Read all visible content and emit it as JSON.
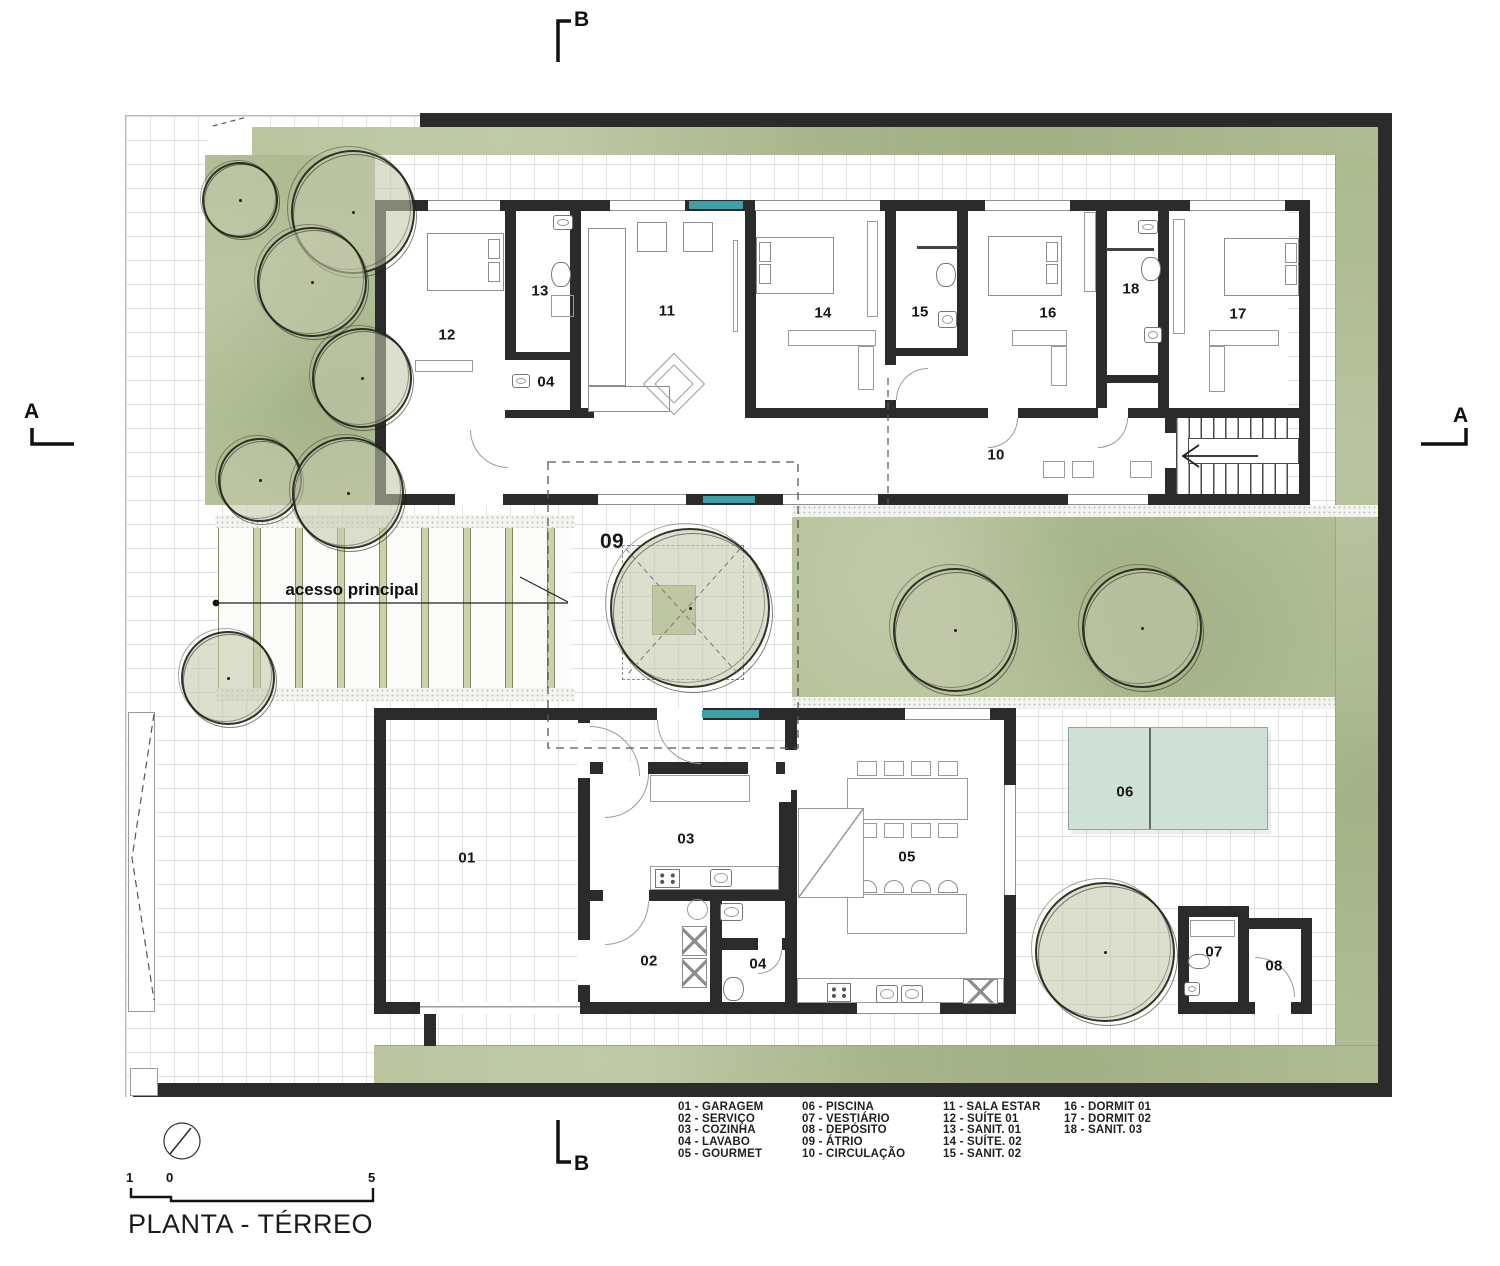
{
  "title": "PLANTA - TÉRREO",
  "annotations": {
    "access_label": "acesso principal",
    "section_a": "A",
    "section_b": "B"
  },
  "scale_bar": {
    "n1": "1",
    "n0": "0",
    "n5": "5"
  },
  "rooms": {
    "garagem": "01",
    "servico": "02",
    "cozinha": "03",
    "lavabo": "04",
    "gourmet": "05",
    "piscina": "06",
    "vestiario": "07",
    "deposito": "08",
    "atrio": "09",
    "circulacao": "10",
    "sala_estar": "11",
    "suite_01": "12",
    "sanit_01": "13",
    "suite_02": "14",
    "sanit_02": "15",
    "dormit_01": "16",
    "dormit_02": "17",
    "sanit_03": "18"
  },
  "legend": {
    "col1": [
      "01 - GARAGEM",
      "02 - SERVIÇO",
      "03 - COZINHA",
      "04 - LAVABO",
      "05 - GOURMET"
    ],
    "col2": [
      "06 - PISCINA",
      "07 - VESTIÁRIO",
      "08 - DEPÓSITO",
      "09 - ÁTRIO",
      "10 - CIRCULAÇÃO"
    ],
    "col3": [
      "11 - SALA ESTAR",
      "12 - SUÍTE 01",
      "13 - SANIT. 01",
      "14 - SUÍTE. 02",
      "15 - SANIT. 02"
    ],
    "col4": [
      "16 - DORMIT 01",
      "17 - DORMIT 02",
      "18 - SANIT. 03"
    ]
  },
  "colors": {
    "wall": "#2b2b2b",
    "grass": "#b5c199",
    "tree_fill": "#c4caa8",
    "pool": "#cfe0d6",
    "window_accent_teal": "#3f9fa6",
    "grid_line": "#e1e1e1",
    "paper": "#ffffff"
  }
}
